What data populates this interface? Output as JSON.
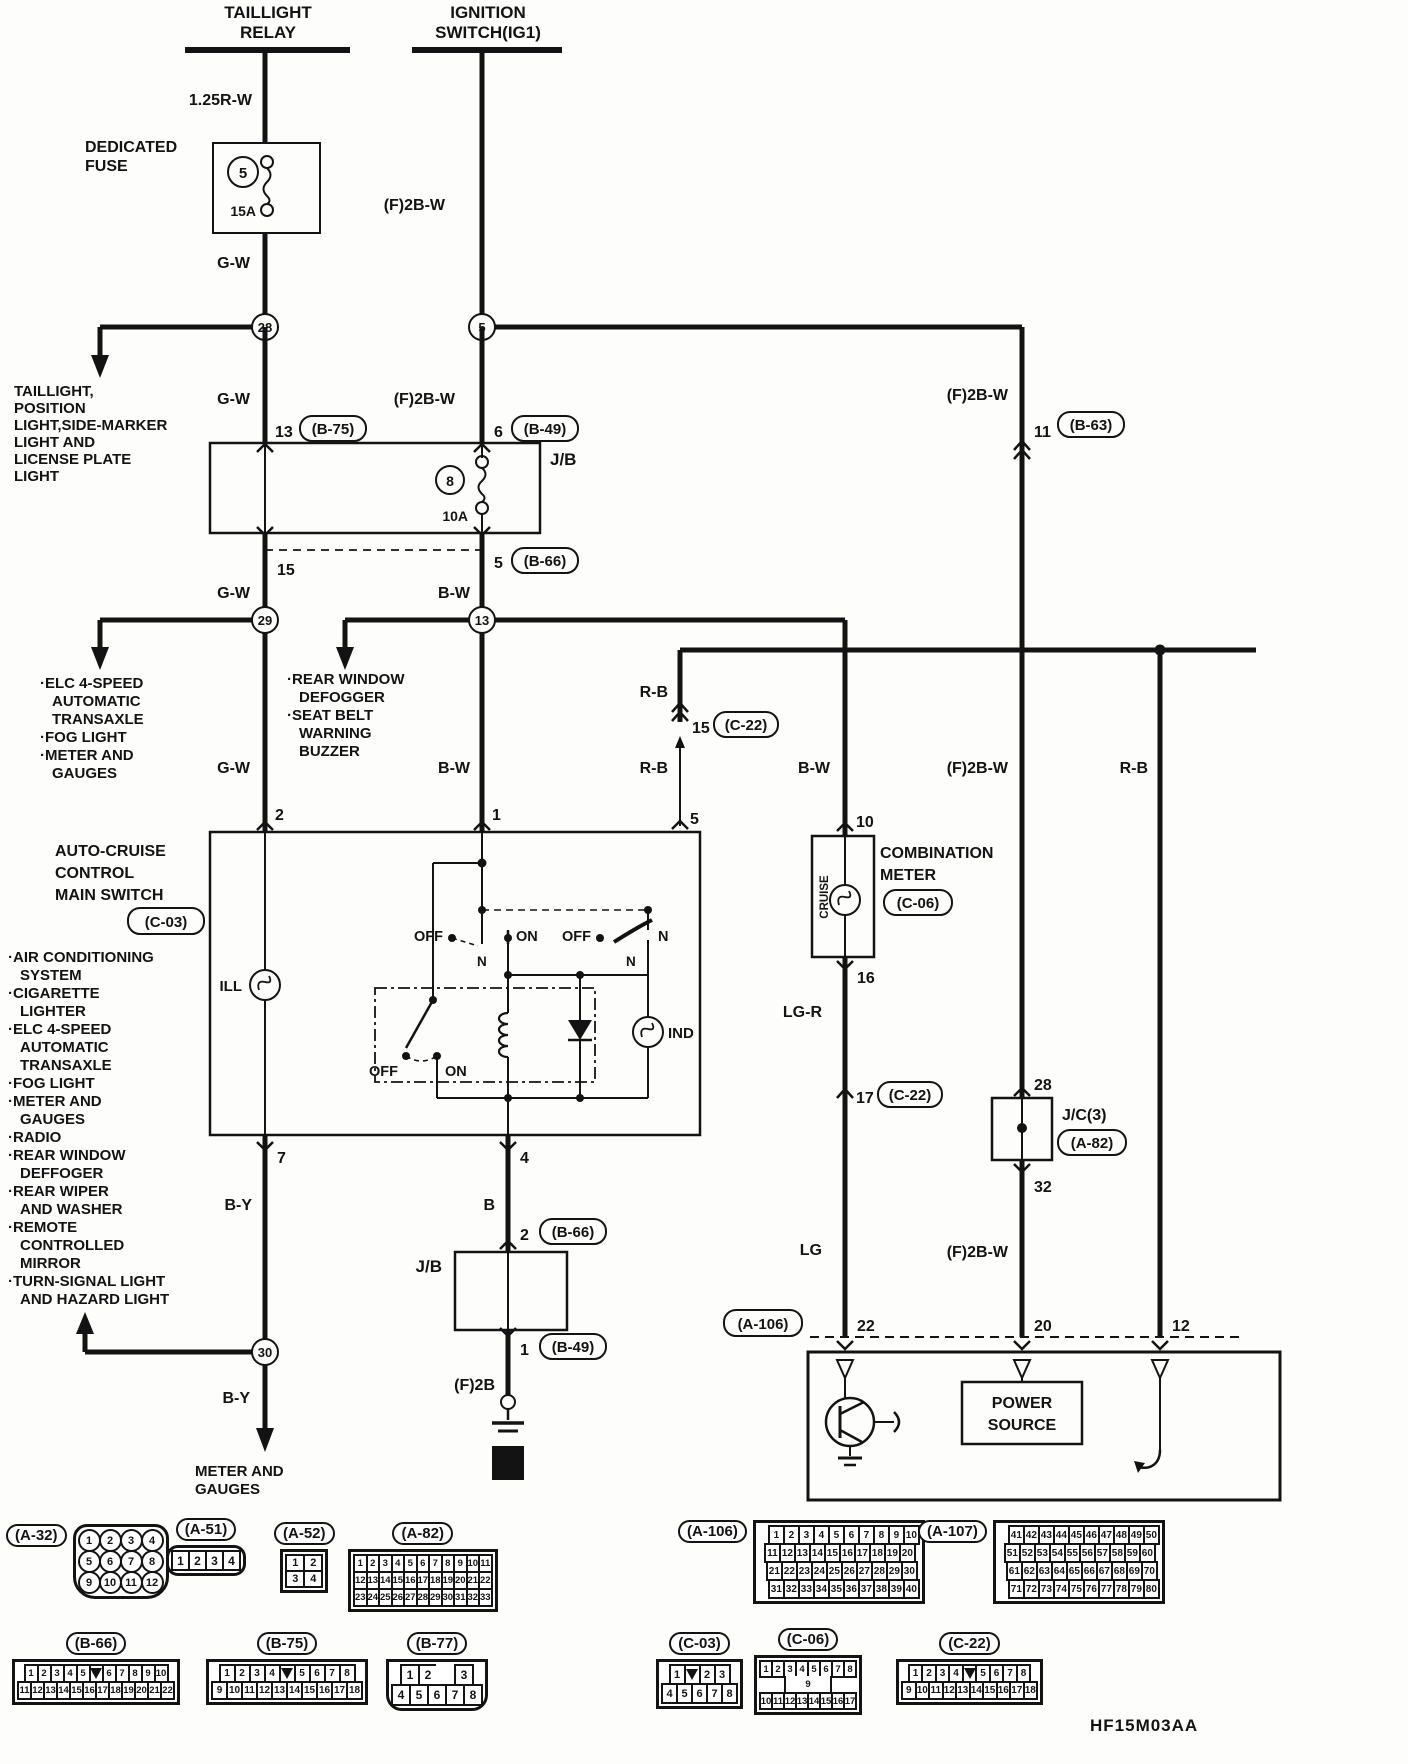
{
  "diagram_code": "HF15M03AA",
  "power_feeds": {
    "taillight_relay": [
      "TAILLIGHT",
      "RELAY"
    ],
    "ignition_switch": [
      "IGNITION",
      "SWITCH(IG1)"
    ]
  },
  "dedicated_fuse": {
    "label": [
      "DEDICATED",
      "FUSE"
    ],
    "number": "5",
    "rating": "15A"
  },
  "junction_block": {
    "label": "J/B",
    "fuse_number": "8",
    "fuse_rating": "10A"
  },
  "wire_colors": {
    "r125w": "1.25R-W",
    "f2bw": "(F)2B-W",
    "gw": "G-W",
    "bw": "B-W",
    "rb": "R-B",
    "by": "B-Y",
    "b": "B",
    "lgr": "LG-R",
    "lg": "LG",
    "f2b": "(F)2B"
  },
  "splice_nodes": {
    "n28": "28",
    "n5": "5",
    "n29": "29",
    "n13": "13",
    "n30": "30"
  },
  "connector_refs": {
    "b75": "(B-75)",
    "b49": "(B-49)",
    "b66": "(B-66)",
    "b63": "(B-63)",
    "c22": "(C-22)",
    "c06": "(C-06)",
    "a82": "(A-82)",
    "a106": "(A-106)"
  },
  "connector_pins": {
    "jb_in_tl": "13",
    "jb_in_ig": "6",
    "jb_out_tl": "15",
    "jb_out_ig": "5",
    "b63_pin": "11",
    "c22_rb_pin": "15",
    "c03_ill": "2",
    "c03_ign": "1",
    "c03_rb": "5",
    "c03_out_by": "7",
    "c03_out_b": "4",
    "c06_in": "10",
    "c06_out": "16",
    "c22_lg_pin": "17",
    "jc3_in": "28",
    "jc3_out": "32",
    "jb2_in": "2",
    "jb2_out": "1",
    "a106_lg": "22",
    "a106_f2bw": "20",
    "a106_rb": "12"
  },
  "branch_destinations": {
    "node28": [
      "TAILLIGHT,",
      "POSITION",
      "LIGHT,SIDE-MARKER",
      "LIGHT AND",
      "LICENSE PLATE",
      "LIGHT"
    ],
    "node29": [
      "·ELC 4-SPEED",
      "AUTOMATIC",
      "TRANSAXLE",
      "·FOG LIGHT",
      "·METER AND",
      "GAUGES"
    ],
    "node13": [
      "·REAR WINDOW",
      "DEFOGGER",
      "·SEAT BELT",
      "WARNING",
      "BUZZER"
    ],
    "node30": [
      "METER AND",
      "GAUGES"
    ]
  },
  "auto_cruise_main_switch": {
    "title": [
      "AUTO-CRUISE",
      "CONTROL",
      "MAIN SWITCH"
    ],
    "ref": "(C-03)",
    "ill_lamp": "ILL",
    "ind_lamp": "IND",
    "sw_off": "OFF",
    "sw_on": "ON",
    "sw_n": "N",
    "connected_systems": [
      "·AIR CONDITIONING",
      "SYSTEM",
      "·CIGARETTE",
      "LIGHTER",
      "·ELC 4-SPEED",
      "AUTOMATIC",
      "TRANSAXLE",
      "·FOG LIGHT",
      "·METER AND",
      "GAUGES",
      "·RADIO",
      "·REAR WINDOW",
      "DEFFOGER",
      "·REAR WIPER",
      "AND WASHER",
      "·REMOTE",
      "CONTROLLED",
      "MIRROR",
      "·TURN-SIGNAL LIGHT",
      "AND HAZARD LIGHT"
    ]
  },
  "combination_meter": {
    "title": [
      "COMBINATION",
      "METER"
    ],
    "ref": "(C-06)",
    "cruise_label": "CRUISE"
  },
  "joint_connector": {
    "label": "J/C(3)",
    "ref": "(A-82)"
  },
  "power_source_box": [
    "POWER",
    "SOURCE"
  ],
  "ground_ref": "5",
  "bottom_connectors": [
    {
      "id": "A-32",
      "label": "(A-32)",
      "type": "circles",
      "rows": [
        [
          "1",
          "2",
          "3",
          "4"
        ],
        [
          "5",
          "6",
          "7",
          "8"
        ],
        [
          "9",
          "10",
          "11",
          "12"
        ]
      ]
    },
    {
      "id": "A-51",
      "label": "(A-51)",
      "type": "pill",
      "rows": [
        [
          "1",
          "2",
          "3",
          "4"
        ]
      ]
    },
    {
      "id": "A-52",
      "label": "(A-52)",
      "type": "grid",
      "rows": [
        [
          "1",
          "2"
        ],
        [
          "3",
          "4"
        ]
      ]
    },
    {
      "id": "A-82",
      "label": "(A-82)",
      "type": "grid",
      "rows": [
        [
          "1",
          "2",
          "3",
          "4",
          "5",
          "6",
          "7",
          "8",
          "9",
          "10",
          "11"
        ],
        [
          "12",
          "13",
          "14",
          "15",
          "16",
          "17",
          "18",
          "19",
          "20",
          "21",
          "22"
        ],
        [
          "23",
          "24",
          "25",
          "26",
          "27",
          "28",
          "29",
          "30",
          "31",
          "32",
          "33"
        ]
      ]
    },
    {
      "id": "A-106",
      "label": "(A-106)",
      "type": "grid",
      "rows": [
        [
          "1",
          "2",
          "3",
          "4",
          "5",
          "6",
          "7",
          "8",
          "9",
          "10"
        ],
        [
          "11",
          "12",
          "13",
          "14",
          "15",
          "16",
          "17",
          "18",
          "19",
          "20"
        ],
        [
          "21",
          "22",
          "23",
          "24",
          "25",
          "26",
          "27",
          "28",
          "29",
          "30"
        ],
        [
          "31",
          "32",
          "33",
          "34",
          "35",
          "36",
          "37",
          "38",
          "39",
          "40"
        ]
      ]
    },
    {
      "id": "A-107",
      "label": "(A-107)",
      "type": "grid",
      "rows": [
        [
          "41",
          "42",
          "43",
          "44",
          "45",
          "46",
          "47",
          "48",
          "49",
          "50"
        ],
        [
          "51",
          "52",
          "53",
          "54",
          "55",
          "56",
          "57",
          "58",
          "59",
          "60"
        ],
        [
          "61",
          "62",
          "63",
          "64",
          "65",
          "66",
          "67",
          "68",
          "69",
          "70"
        ],
        [
          "71",
          "72",
          "73",
          "74",
          "75",
          "76",
          "77",
          "78",
          "79",
          "80"
        ]
      ]
    },
    {
      "id": "B-66",
      "label": "(B-66)",
      "type": "grid",
      "rows": [
        [
          "1",
          "2",
          "3",
          "4",
          "5",
          "#",
          "6",
          "7",
          "8",
          "9",
          "10"
        ],
        [
          "11",
          "12",
          "13",
          "14",
          "15",
          "16",
          "17",
          "18",
          "19",
          "20",
          "21",
          "22"
        ]
      ]
    },
    {
      "id": "B-75",
      "label": "(B-75)",
      "type": "grid",
      "rows": [
        [
          "1",
          "2",
          "3",
          "4",
          "#",
          "5",
          "6",
          "7",
          "8"
        ],
        [
          "9",
          "10",
          "11",
          "12",
          "13",
          "14",
          "15",
          "16",
          "17",
          "18"
        ]
      ]
    },
    {
      "id": "B-77",
      "label": "(B-77)",
      "type": "grid",
      "rows": [
        [
          "1",
          "2",
          "",
          "3"
        ],
        [
          "4",
          "5",
          "6",
          "7",
          "8"
        ]
      ]
    },
    {
      "id": "C-03",
      "label": "(C-03)",
      "type": "grid",
      "rows": [
        [
          "1",
          "#",
          "2",
          "3"
        ],
        [
          "4",
          "5",
          "6",
          "7",
          "8"
        ]
      ]
    },
    {
      "id": "C-06",
      "label": "(C-06)",
      "type": "grid",
      "rows": [
        [
          "1",
          "2",
          "3",
          "4",
          "5",
          "6",
          "7",
          "8"
        ],
        [
          "9"
        ],
        [
          "10",
          "11",
          "12",
          "13",
          "14",
          "15",
          "16",
          "17"
        ]
      ]
    },
    {
      "id": "C-22",
      "label": "(C-22)",
      "type": "grid",
      "rows": [
        [
          "1",
          "2",
          "3",
          "4",
          "#",
          "5",
          "6",
          "7",
          "8"
        ],
        [
          "9",
          "10",
          "11",
          "12",
          "13",
          "14",
          "15",
          "16",
          "17",
          "18"
        ]
      ]
    }
  ]
}
